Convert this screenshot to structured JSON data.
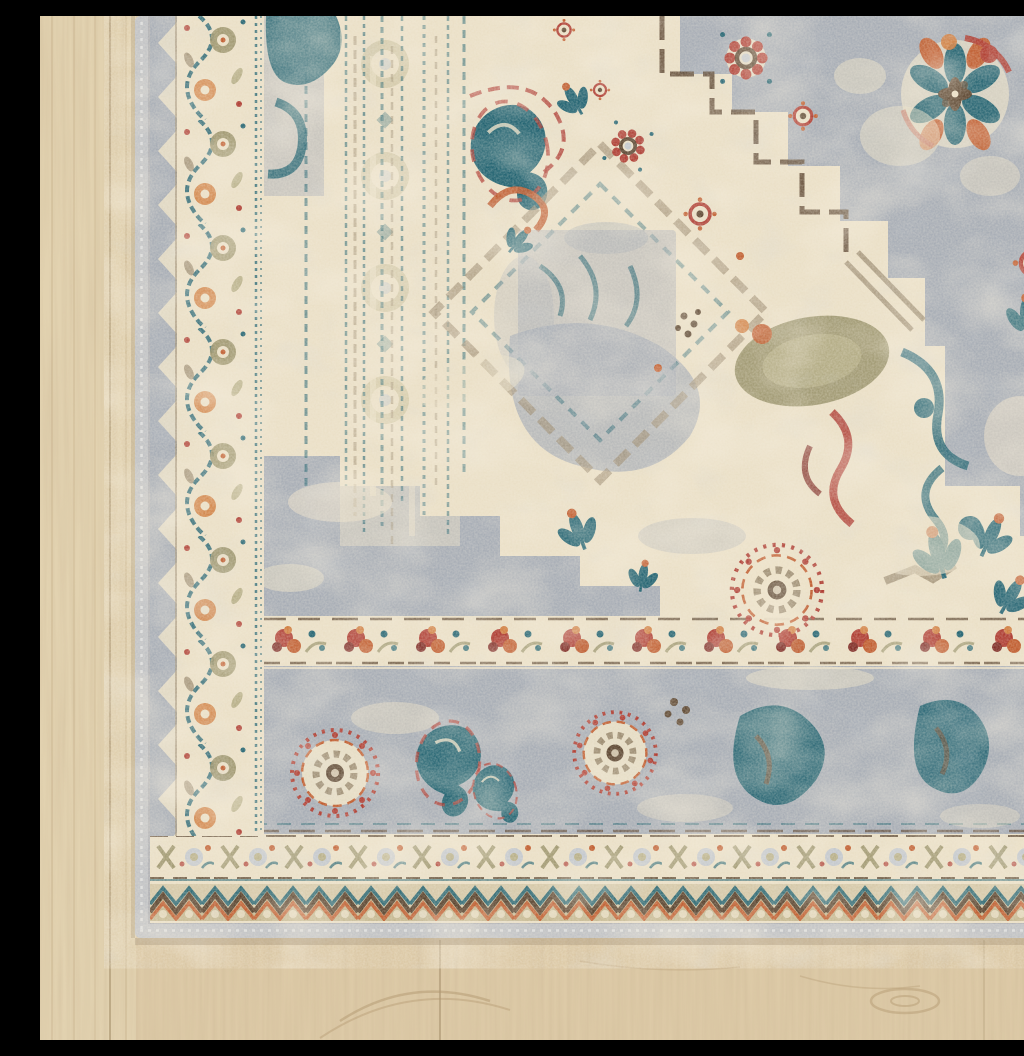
{
  "meta": {
    "type": "product-photograph",
    "alt": "Corner detail of a distressed vintage-style oriental area rug with a gray-blue field, cream stepped medallion, teal, rust, red and olive floral motifs and a gray serged binding edge, lying flat on a light oak wood plank floor",
    "subject": "vintage medallion area rug on light wood floor",
    "camera_view": "top-down corner detail, rug corner at lower left"
  },
  "scene": {
    "floor": {
      "label": "light oak plank floor",
      "grain_direction": "vertical",
      "features": [
        "plank seams",
        "fine grain streaks",
        "knot swirl lower right"
      ]
    },
    "rug": {
      "label": "distressed traditional area rug",
      "visible_corner": "bottom-left",
      "binding": "gray serged selvage edge",
      "field_color_name": "gray-blue",
      "motifs": [
        "stepped cream medallion",
        "eight-petal blossom",
        "fan rosette",
        "boteh paisley scroll",
        "vine meander border",
        "floral chain border",
        "chevron zigzag guard border",
        "leaf sprigs",
        "distressed warp stripes"
      ],
      "borders_outside_in": [
        {
          "label": "selvage",
          "color_key": "selvage"
        },
        {
          "label": "chevron zigzag guard",
          "color_key": "tan-band"
        },
        {
          "label": "floral chain band",
          "color_key": "cream"
        },
        {
          "label": "main border with rosettes and paisleys",
          "color_key": "field-gray"
        },
        {
          "label": "red rosette guard band",
          "color_key": "cream"
        },
        {
          "label": "vine meander band",
          "color_key": "cream"
        }
      ]
    }
  },
  "palette": {
    "wood-base": "#d9c4a0",
    "wood-light": "#ecdfc0",
    "wood-grain": "#b2976f",
    "wood-shadow": "#a08a66",
    "selvage": "#c0c2c5",
    "selvage-light": "#dcddde",
    "cream": "#eadfc6",
    "cream-dark": "#d9cca9",
    "field-gray": "#a6acb5",
    "field-gray-light": "#c3c8ce",
    "teal": "#1f6170",
    "teal-light": "#4b8694",
    "rust": "#bf5a2c",
    "orange": "#d07c3e",
    "red": "#ad3a30",
    "dark-red": "#7e2a24",
    "olive": "#99926a",
    "olive-light": "#b7af88",
    "brown": "#58422d",
    "taupe": "#9b8b70",
    "tan-band": "#c4b790"
  }
}
